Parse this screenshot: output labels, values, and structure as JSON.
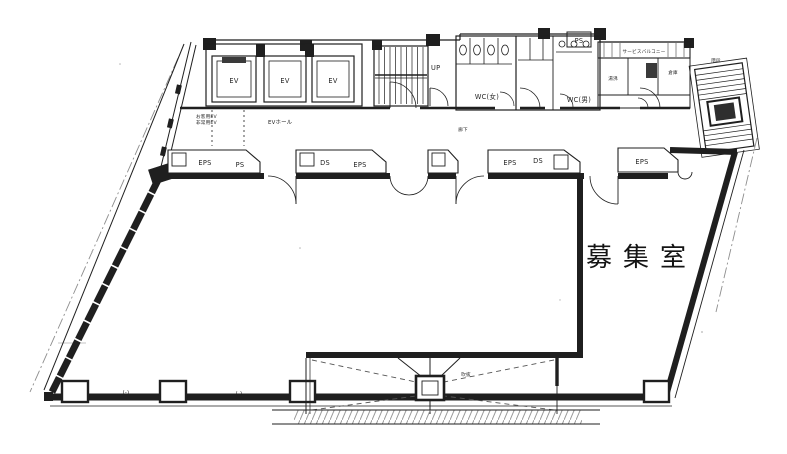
{
  "drawing": {
    "vacancy_room_label": "募集室",
    "elevators": {
      "ev1": "EV",
      "ev2": "EV",
      "ev3": "EV",
      "note_line1": "お客用EV",
      "note_line2": "非常用EV",
      "hall_label": "EVホール"
    },
    "stair": {
      "up_label": "UP",
      "ext_label": "階段"
    },
    "wc": {
      "women_label": "WC(女)",
      "men_label": "WC(男)"
    },
    "balcony": {
      "label": "サービスバルコニー",
      "ps_label": "PS",
      "utility1_label": "湯沸",
      "utility2_label": "倉庫"
    },
    "corridor_label": "廊下",
    "shafts": {
      "a1": "EPS",
      "a2": "PS",
      "b1": "DS",
      "b2": "EPS",
      "d1": "EPS",
      "d2": "DS",
      "e1": "EPS"
    },
    "canopy": {
      "void_label": "吹抜"
    },
    "dims": {
      "dim1": "(-)",
      "dim2": "(-)"
    }
  },
  "colors": {
    "ink": "#1f1f1f",
    "paper": "#ffffff",
    "gray_line": "#8d8d8d",
    "hatch": "#9a9a9a"
  }
}
